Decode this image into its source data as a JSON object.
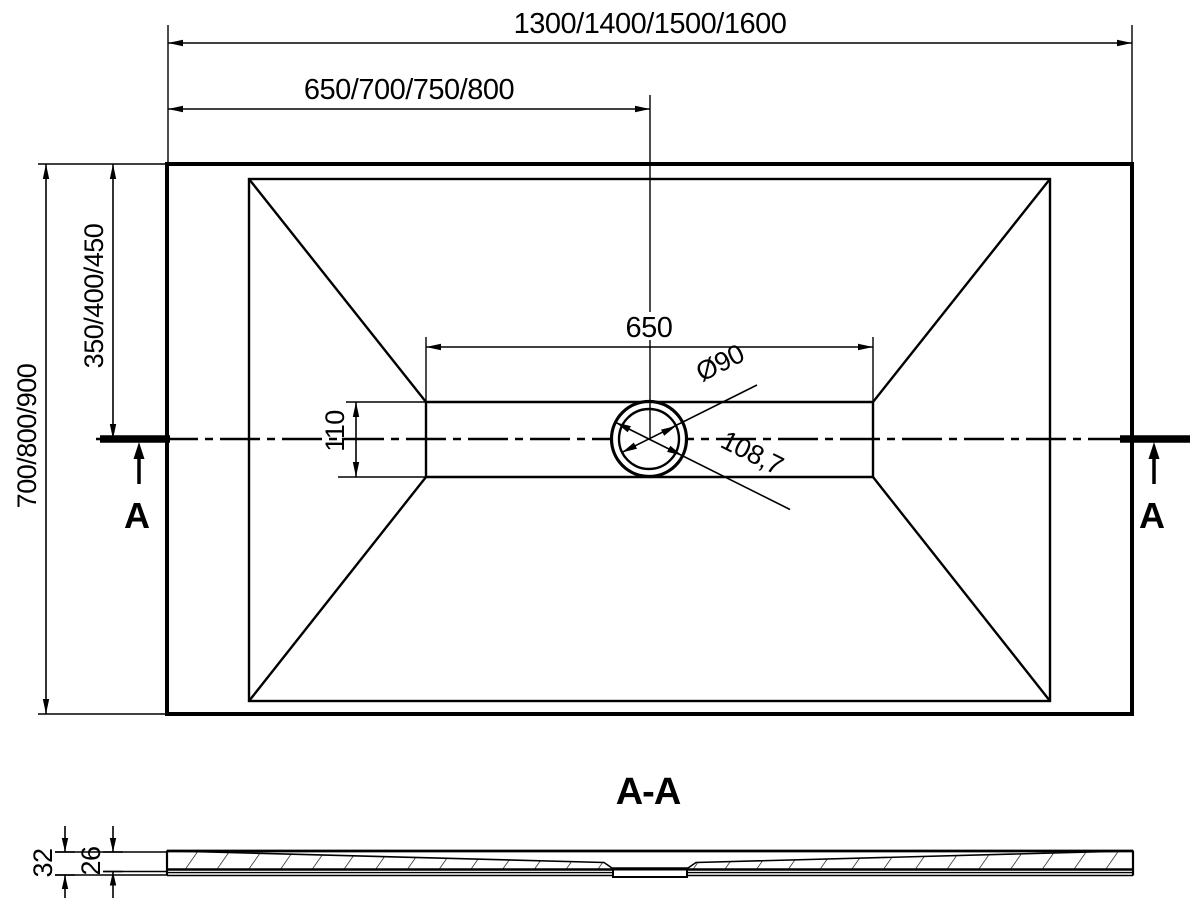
{
  "plan_view": {
    "dim_width_options": "1300/1400/1500/1600",
    "dim_width_to_drain_options": "650/700/750/800",
    "dim_depth_options": "700/800/900",
    "dim_depth_to_drain_options": "350/400/450",
    "dim_channel_length": "650",
    "dim_channel_width": "110",
    "dim_drain_diameter": "Ø90",
    "dim_drain_diagonal": "108,7",
    "section_marker_left": "A",
    "section_marker_right": "A"
  },
  "section_view": {
    "title": "A-A",
    "dim_thickness_overall": "32",
    "dim_thickness_base": "26"
  },
  "colors": {
    "line": "#000000",
    "background": "#ffffff"
  }
}
